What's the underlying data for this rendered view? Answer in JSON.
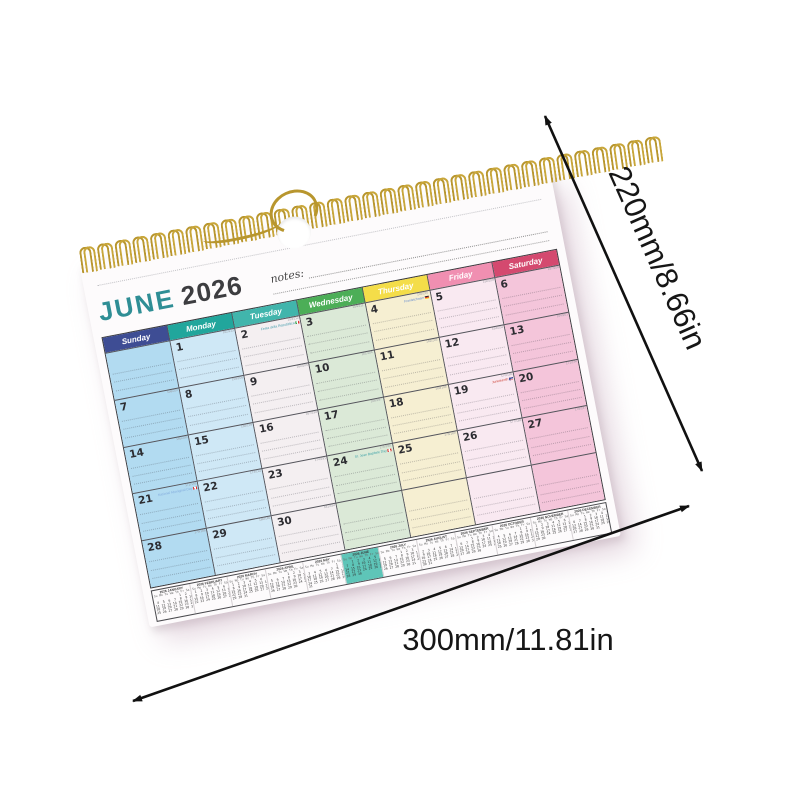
{
  "scene": {
    "background_color": "#ffffff"
  },
  "dimensions": {
    "height_label": "220mm/8.66in",
    "width_label": "300mm/11.81in",
    "arrow_color": "#111111"
  },
  "calendar": {
    "title_month": "JUNE",
    "title_year": "2026",
    "title_month_color": "#2f8e95",
    "title_year_color": "#3d3d40",
    "notes_label": "notes:",
    "spiral_color": "#b8962e",
    "mini_highlight_color": "#5ec5b8",
    "days": [
      {
        "name": "Sunday",
        "header_color": "#3e4d94",
        "body_color": "#b2dbf1"
      },
      {
        "name": "Monday",
        "header_color": "#21a69c",
        "body_color": "#cfe8f6"
      },
      {
        "name": "Tuesday",
        "header_color": "#41b5ac",
        "body_color": "#f4eff1"
      },
      {
        "name": "Wednesday",
        "header_color": "#4cae57",
        "body_color": "#dbe9d7"
      },
      {
        "name": "Thursday",
        "header_color": "#f4dd49",
        "body_color": "#f6efd2"
      },
      {
        "name": "Friday",
        "header_color": "#f08fb1",
        "body_color": "#f9e9f1"
      },
      {
        "name": "Saturday",
        "header_color": "#d4496f",
        "body_color": "#f4c5da"
      }
    ],
    "weeks": [
      [
        "",
        "1",
        "2",
        "3",
        "4",
        "5",
        "6"
      ],
      [
        "7",
        "8",
        "9",
        "10",
        "11",
        "12",
        "13"
      ],
      [
        "14",
        "15",
        "16",
        "17",
        "18",
        "19",
        "20"
      ],
      [
        "21",
        "22",
        "23",
        "24",
        "25",
        "26",
        "27"
      ],
      [
        "28",
        "29",
        "30",
        "",
        "",
        "",
        ""
      ]
    ],
    "day_of_year": [
      [
        "",
        "152/213",
        "153/212",
        "154/211",
        "155/210",
        "156/209",
        "157/208"
      ],
      [
        "158/207",
        "159/206",
        "160/205",
        "161/204",
        "162/203",
        "163/202",
        "164/201"
      ],
      [
        "165/200",
        "166/199",
        "167/198",
        "168/197",
        "169/196",
        "170/195",
        "171/194"
      ],
      [
        "172/193",
        "173/192",
        "174/191",
        "175/190",
        "176/189",
        "177/188",
        "178/187"
      ],
      [
        "179/186",
        "180/185",
        "181/184",
        "",
        "",
        "",
        ""
      ]
    ],
    "holidays": [
      {
        "date": "2",
        "label": "Festa della Repubblica",
        "flag": "italy",
        "color": "#4a9fae"
      },
      {
        "date": "4",
        "label": "Fronleichnam",
        "flag": "germany",
        "color": "#6b8fd0"
      },
      {
        "date": "19",
        "label": "Juneteenth",
        "flag": "usa",
        "color": "#cf4a3f"
      },
      {
        "date": "21",
        "label": "National Aboriginal Day",
        "flag": "canada",
        "color": "#85aede"
      },
      {
        "date": "24",
        "label": "St. Jean Baptiste Day",
        "flag": "canada",
        "color": "#3fa3a8"
      }
    ],
    "mini_dow": "Su Mo Tu We Th Fr Sa",
    "mini_months": [
      {
        "label": "2026 JANUARY",
        "weeks": [
          "             1  2  3",
          " 4  5  6  7  8  9 10",
          "11 12 13 14 15 16 17",
          "18 19 20 21 22 23 24",
          "25 26 27 28 29 30 31"
        ]
      },
      {
        "label": "2026 FEBRUARY",
        "weeks": [
          " 1  2  3  4  5  6  7",
          " 8  9 10 11 12 13 14",
          "15 16 17 18 19 20 21",
          "22 23 24 25 26 27 28"
        ]
      },
      {
        "label": "2026 MARCH",
        "weeks": [
          " 1  2  3  4  5  6  7",
          " 8  9 10 11 12 13 14",
          "15 16 17 18 19 20 21",
          "22 23 24 25 26 27 28",
          "29 30 31"
        ]
      },
      {
        "label": "2026 APRIL",
        "weeks": [
          "          1  2  3  4",
          " 5  6  7  8  9 10 11",
          "12 13 14 15 16 17 18",
          "19 20 21 22 23 24 25",
          "26 27 28 29 30"
        ]
      },
      {
        "label": "2026 MAY",
        "weeks": [
          "                1  2",
          " 3  4  5  6  7  8  9",
          "10 11 12 13 14 15 16",
          "17 18 19 20 21 22 23",
          "24 25 26 27 28 29 30",
          "31"
        ]
      },
      {
        "label": "2026 JUNE",
        "highlight": true,
        "weeks": [
          "    1  2  3  4  5  6",
          " 7  8  9 10 11 12 13",
          "14 15 16 17 18 19 20",
          "21 22 23 24 25 26 27",
          "28 29 30"
        ]
      },
      {
        "label": "2026 JULY",
        "weeks": [
          "          1  2  3  4",
          " 5  6  7  8  9 10 11",
          "12 13 14 15 16 17 18",
          "19 20 21 22 23 24 25",
          "26 27 28 29 30 31"
        ]
      },
      {
        "label": "2026 AUGUST",
        "weeks": [
          "                   1",
          " 2  3  4  5  6  7  8",
          " 9 10 11 12 13 14 15",
          "16 17 18 19 20 21 22",
          "23 24 25 26 27 28 29",
          "30 31"
        ]
      },
      {
        "label": "2026 SEPTEMBER",
        "weeks": [
          "       1  2  3  4  5",
          " 6  7  8  9 10 11 12",
          "13 14 15 16 17 18 19",
          "20 21 22 23 24 25 26",
          "27 28 29 30"
        ]
      },
      {
        "label": "2026 OCTOBER",
        "weeks": [
          "             1  2  3",
          " 4  5  6  7  8  9 10",
          "11 12 13 14 15 16 17",
          "18 19 20 21 22 23 24",
          "25 26 27 28 29 30 31"
        ]
      },
      {
        "label": "2026 NOVEMBER",
        "weeks": [
          " 1  2  3  4  5  6  7",
          " 8  9 10 11 12 13 14",
          "15 16 17 18 19 20 21",
          "22 23 24 25 26 27 28",
          "29 30"
        ]
      },
      {
        "label": "2026 DECEMBER",
        "weeks": [
          "       1  2  3  4  5",
          " 6  7  8  9 10 11 12",
          "13 14 15 16 17 18 19",
          "20 21 22 23 24 25 26",
          "27 28 29 30 31"
        ]
      }
    ]
  }
}
